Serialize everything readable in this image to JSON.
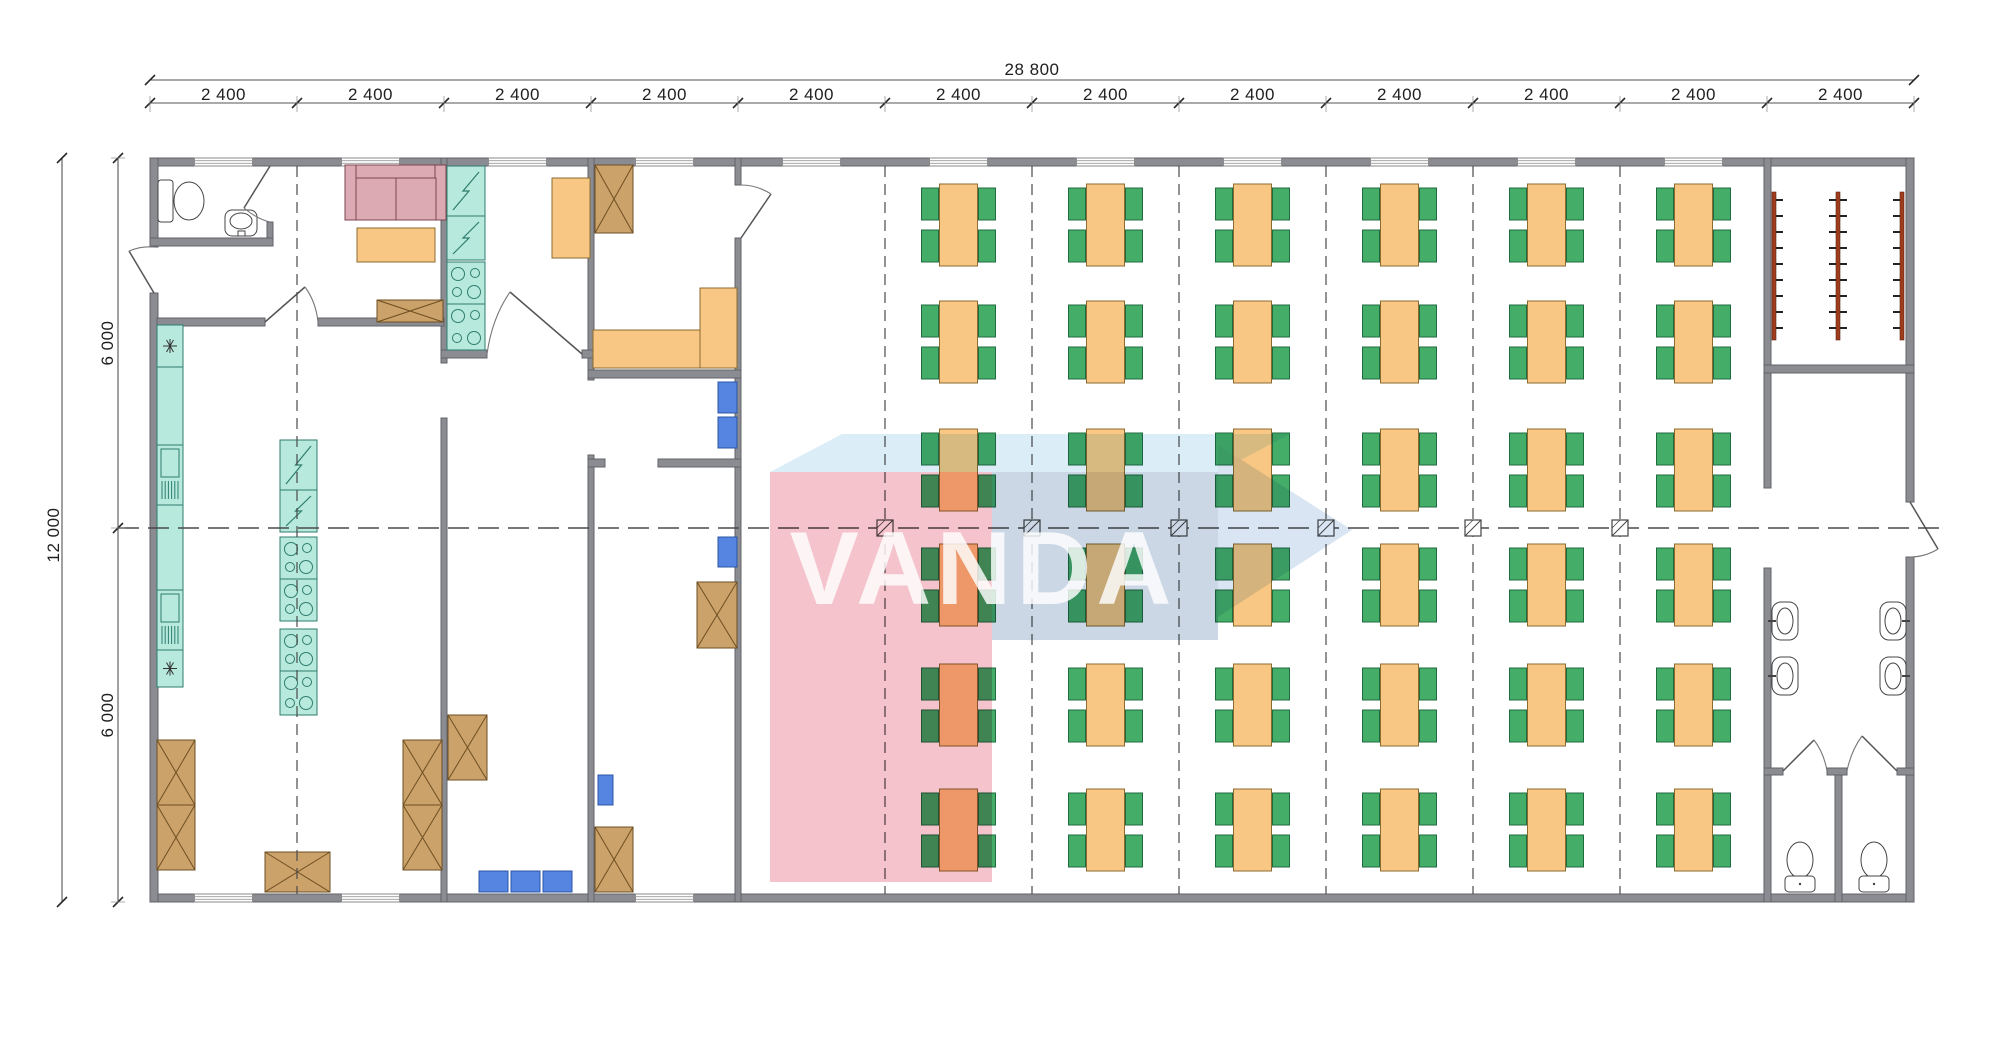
{
  "watermark": {
    "text": "VANDA"
  },
  "dimensions": {
    "top_total": "28 800",
    "top_segment_label": "2 400",
    "top_segment_count": 12,
    "left_total": "12 000",
    "left_segment_label": "6 000",
    "left_segment_count": 2
  },
  "plan": {
    "modules": 12,
    "dining_tables": {
      "columns": 6,
      "rows": 6,
      "seats_per_table": 4
    },
    "counts": {
      "coat_racks": 3,
      "washroom_sinks": 4,
      "wc_stalls": 2,
      "toilets": 3,
      "dining_tables": 36
    },
    "colors": {
      "wall": "#8b8c91",
      "wall_edge": "#62636a",
      "table": "#f9c784",
      "table_edge": "#8a6b30",
      "chair": "#44ad68",
      "chair_edge": "#1f6b40",
      "equipment": "#b7e9dd",
      "equipment_edge": "#2e7d6e",
      "crate": "#cba269",
      "crate_edge": "#6e4f22",
      "sofa": "#dcaab2",
      "sofa_edge": "#7d4550",
      "seat_blue": "#5585e0",
      "seat_blue_edge": "#2c55a8",
      "coat_rack": "#a03c1e",
      "sanitary_edge": "#444444",
      "line": "#4a4a4a",
      "dim_line": "#555555",
      "watermark_pink": "#f3bdc6",
      "watermark_top": "#d7edf8",
      "watermark_body": "#c6d3e3",
      "watermark_head": "#d5e3f1"
    }
  }
}
